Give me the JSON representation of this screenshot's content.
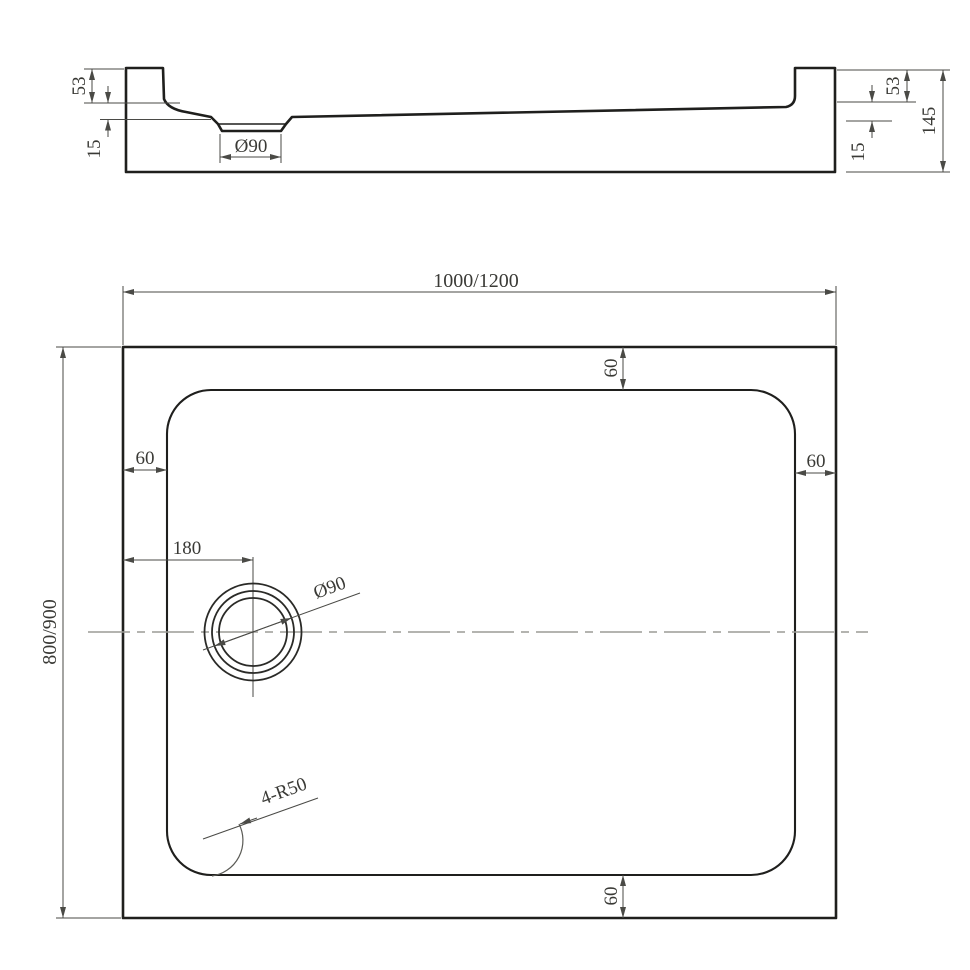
{
  "title": "Rectangular shower tray technical drawing",
  "section_view": {
    "rim_height_left": "53",
    "floor_step_left": "15",
    "drain_diameter": "Ø90",
    "rim_height_right": "53",
    "floor_step_right": "15",
    "overall_height": "145"
  },
  "plan_view": {
    "overall_width": "1000/1200",
    "overall_depth": "800/900",
    "inset_top": "60",
    "inset_left": "60",
    "inset_right": "60",
    "inset_bottom": "60",
    "drain_offset": "180",
    "drain_diameter": "Ø90",
    "corner_radius": "4-R50"
  },
  "colors": {
    "outline": "#1f1f1d",
    "dimension": "#4a4a46",
    "centerline": "#9c9c96",
    "text": "#3a3a36",
    "background": "#ffffff"
  }
}
